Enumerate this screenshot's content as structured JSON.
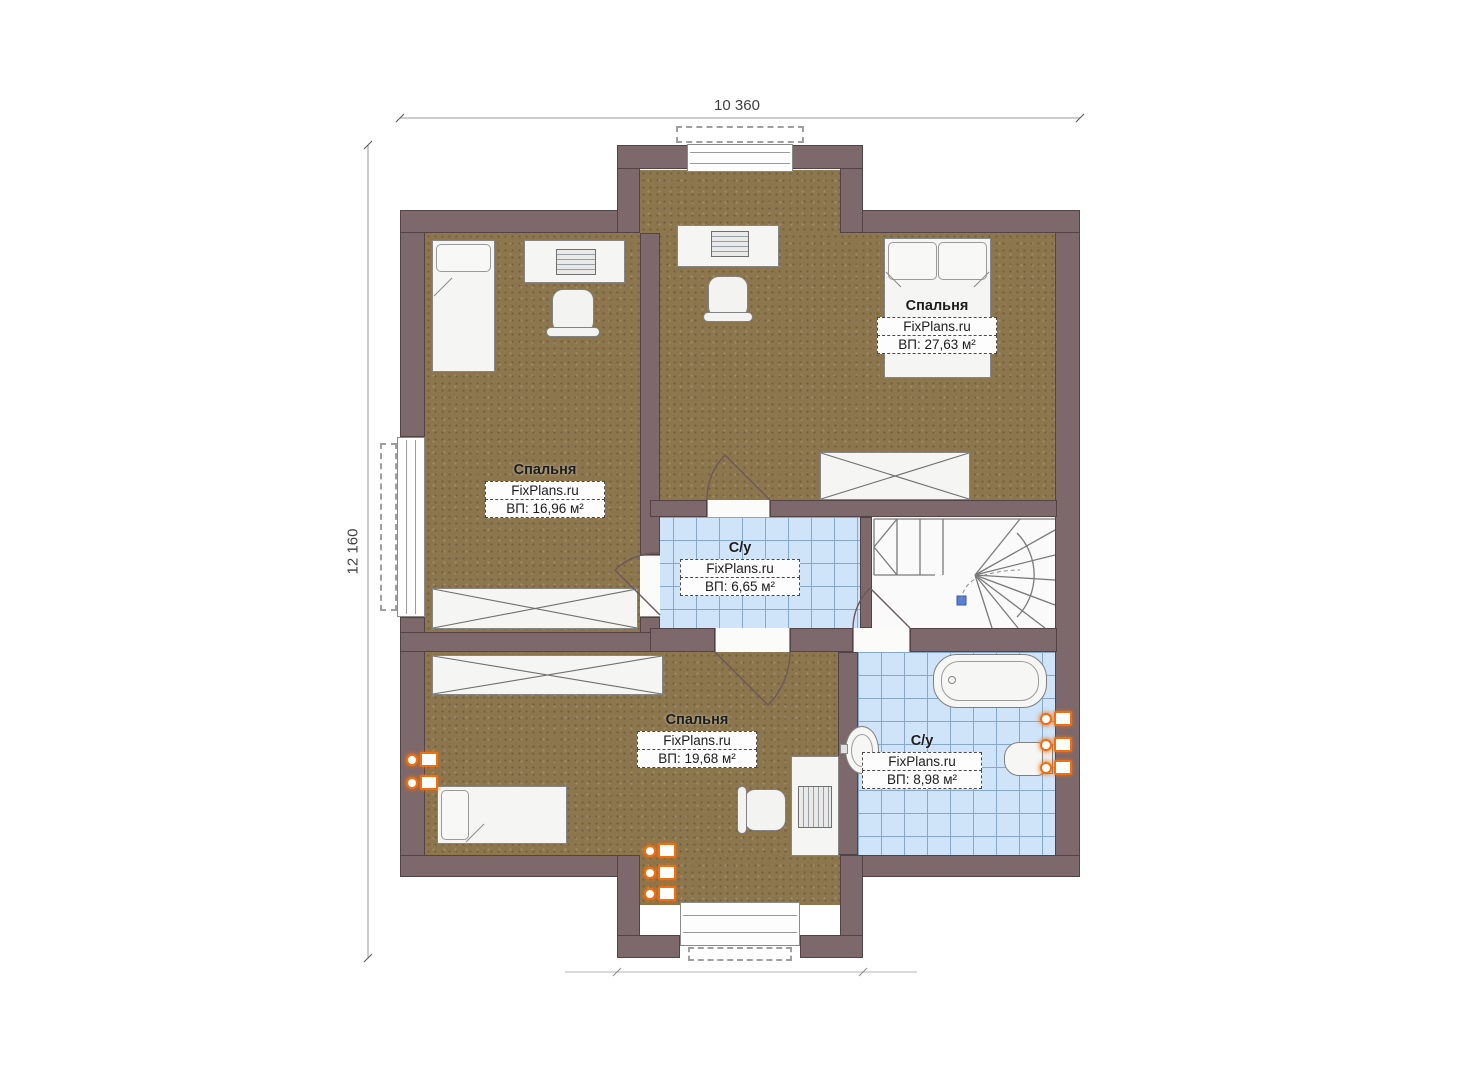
{
  "dimensions": {
    "width_label": "10 360",
    "height_label": "12 160"
  },
  "rooms": [
    {
      "id": "bedroom-left",
      "name": "Спальня",
      "watermark": "FixPlans.ru",
      "area": "ВП: 16,96 м²"
    },
    {
      "id": "bedroom-top-right",
      "name": "Спальня",
      "watermark": "FixPlans.ru",
      "area": "ВП: 27,63 м²"
    },
    {
      "id": "bathroom-middle",
      "name": "С/у",
      "watermark": "FixPlans.ru",
      "area": "ВП: 6,65 м²"
    },
    {
      "id": "bedroom-bottom",
      "name": "Спальня",
      "watermark": "FixPlans.ru",
      "area": "ВП: 19,68 м²"
    },
    {
      "id": "bathroom-bottom-right",
      "name": "С/у",
      "watermark": "FixPlans.ru",
      "area": "ВП: 8,98 м²"
    }
  ],
  "colors": {
    "wall": "#7d686b",
    "wall_outline": "#544346",
    "bedroom_floor": "#8c764e",
    "bathroom_tile": "#cfe4f8",
    "tile_grid": "#86a8cf",
    "furniture": "#f5f5f3",
    "radiator_accent": "#ee7012",
    "stair_marker_blue": "#5b7fd4",
    "dimension_text": "#3f3f3f"
  },
  "icons": [
    "single-bed-icon",
    "double-bed-icon",
    "desk-icon",
    "office-chair-icon",
    "wardrobe-icon",
    "staircase-icon",
    "bathtub-icon",
    "sink-icon",
    "toilet-icon",
    "radiator-icon",
    "window-icon",
    "door-swing-icon"
  ]
}
